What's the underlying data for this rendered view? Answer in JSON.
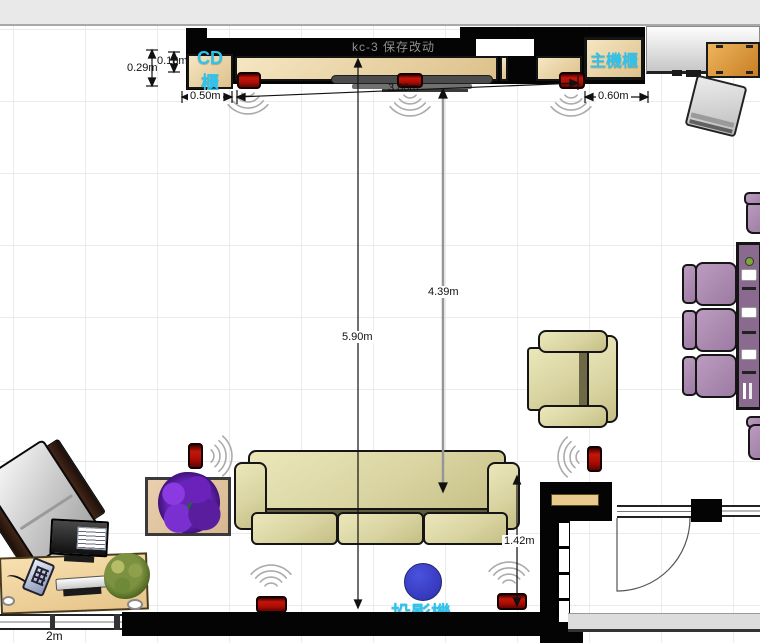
{
  "plan": {
    "note": "kc-3 保存改动",
    "labels": {
      "cd_cabinet": "CD櫃",
      "main_cabinet": "主機櫃",
      "projector": "投影機"
    },
    "dims": {
      "d018": "0.18m",
      "d029": "0.29m",
      "d050": "0.50m",
      "d380": "3.80m",
      "d060": "0.60m",
      "d439": "4.39m",
      "d590": "5.90m",
      "d142": "1.42m",
      "d2m": "2m"
    },
    "colors": {
      "label_cyan": "#2cc3ee",
      "speaker_red": "#b50f06",
      "projector_blue": "#3a3fc4",
      "sofa_khaki": "#d9d49c",
      "dining_chair_purple": "#a88cae",
      "side_cabinet_orange": "#d9952f",
      "wall_black": "#040404"
    }
  }
}
